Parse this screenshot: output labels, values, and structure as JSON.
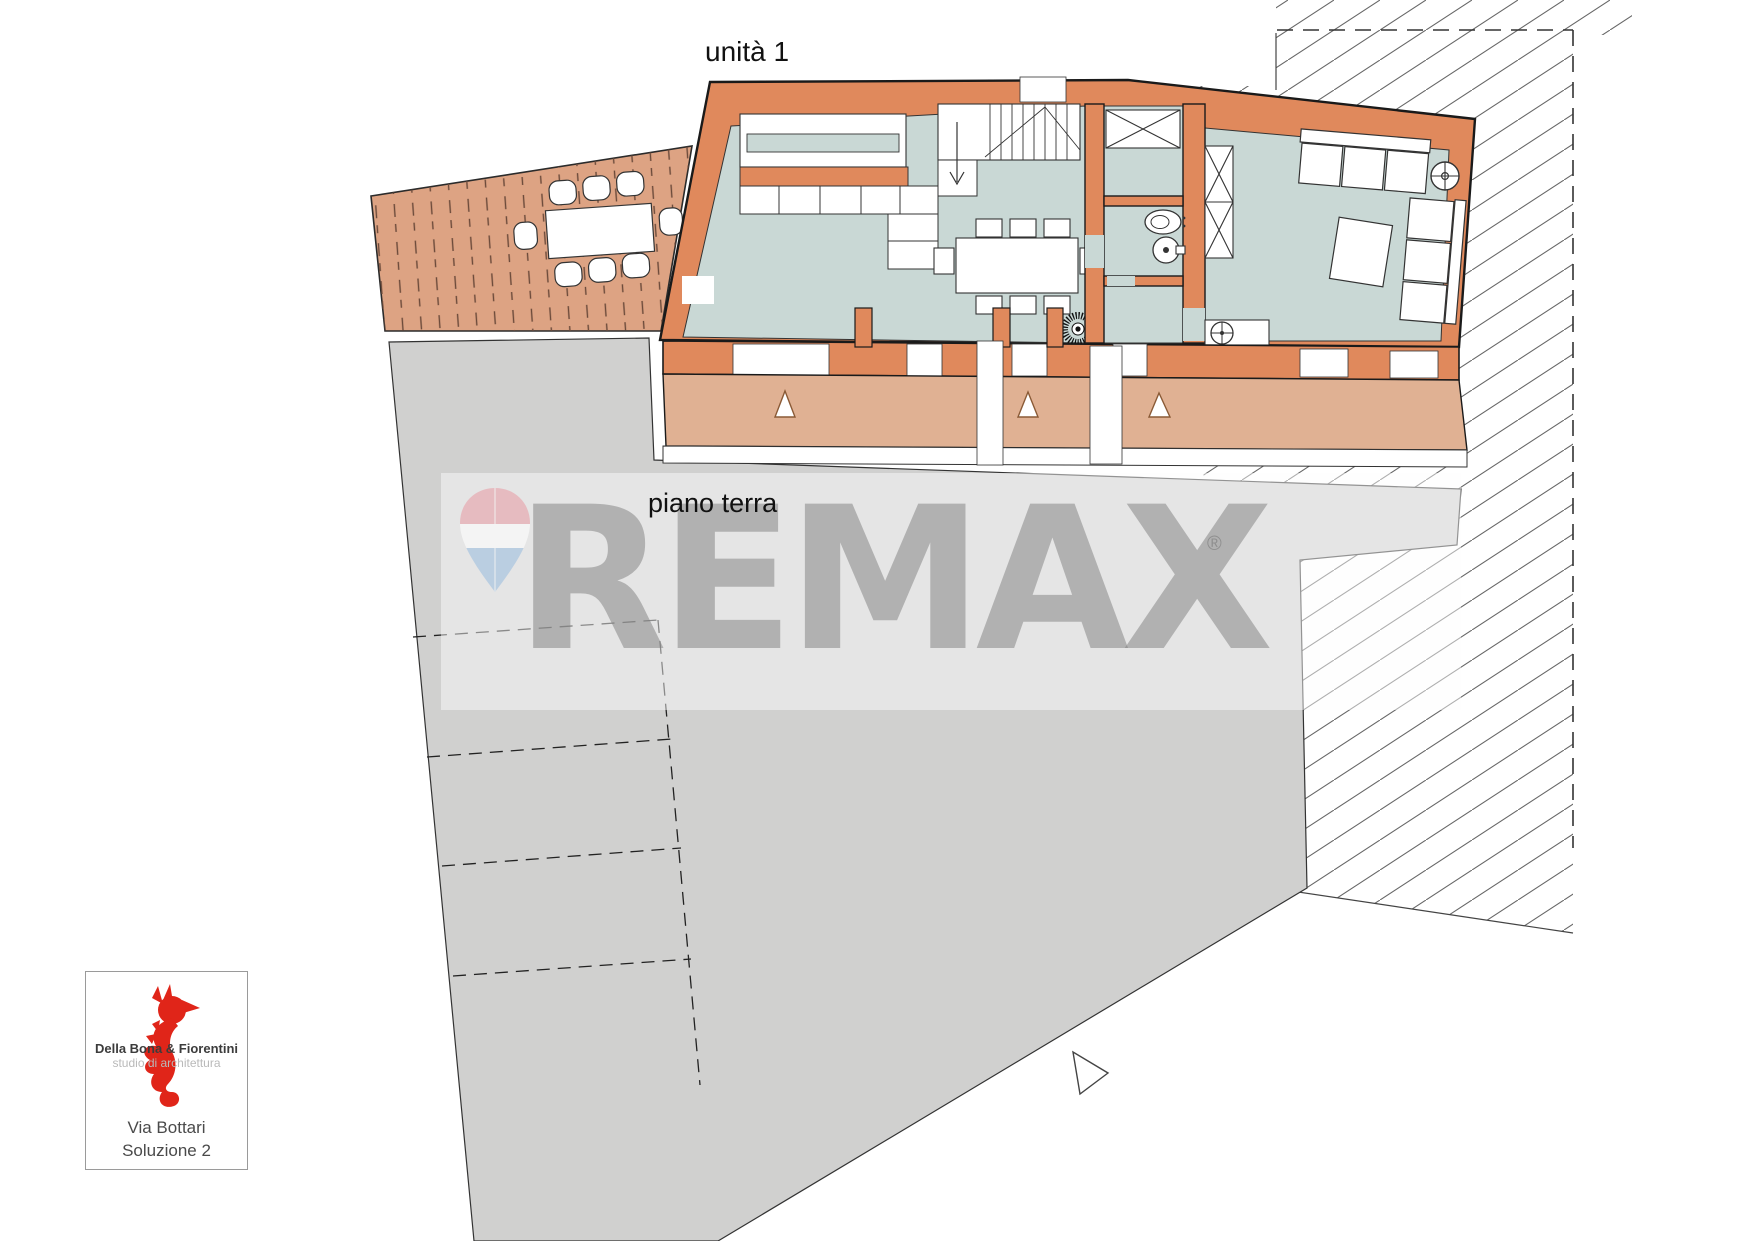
{
  "labels": {
    "unit": "unità 1",
    "floor": "piano terra"
  },
  "watermark": {
    "brand": "REMAX",
    "registered": "®"
  },
  "logo": {
    "studio_name": "Della Bona & Fiorentini",
    "studio_subtitle": "studio di architettura",
    "project_line1": "Via Bottari",
    "project_line2": "Soluzione 2"
  },
  "colors": {
    "wall_orange": "#E0895C",
    "floor_blue": "#C9D8D5",
    "deck_tan": "#DDA383",
    "terrace_tan": "#E0B193",
    "courtyard_gray": "#D0D0CF",
    "logo_red": "#E02519",
    "balloon_red": "#E8A0A8",
    "balloon_blue": "#9FBFDF"
  },
  "plan": {
    "symbols": [
      "stove-icon",
      "floor-drain-icon",
      "ceiling-fan-icon",
      "toilet-icon",
      "bidet-icon",
      "wardrobe-icon",
      "stairs-icon",
      "door-triangle-icon",
      "north-triangle-icon",
      "dining-table-icon",
      "sofa-icon",
      "parking-stall-lines"
    ]
  }
}
